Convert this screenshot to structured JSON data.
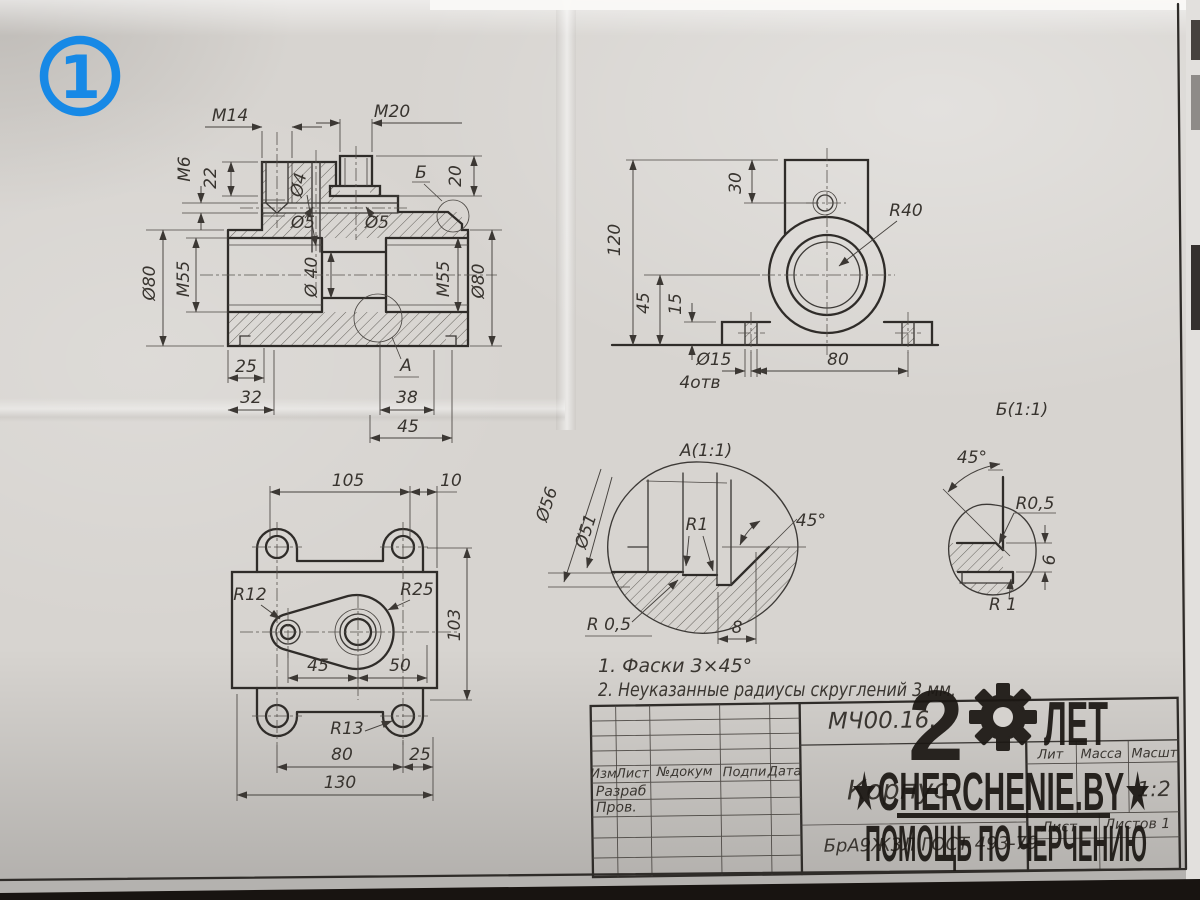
{
  "badge": {
    "number": "1",
    "color": "#1789e6"
  },
  "watermark": {
    "years": "2",
    "years_word": "ЛЕТ",
    "site": "★CHERCHENIE.BY★",
    "tagline": "ПОМОЩЬ ПО ЧЕРЧЕНИЮ",
    "color": "#1b1713"
  },
  "notes": {
    "line1": "1. Фаски 3×45°",
    "line2": "2. Неуказанные радиусы скруглений 3 мм."
  },
  "section_view": {
    "labels": {
      "m14": "М14",
      "m20": "М20",
      "m6": "М6",
      "v22": "22",
      "d4": "Ø4",
      "d5a": "Ø5",
      "d5b": "Ø5",
      "cb": "Б",
      "v20": "20",
      "d80l": "Ø80",
      "m55l": "М55",
      "d40": "Ø 40",
      "m55r": "М55",
      "d80r": "Ø80",
      "v25": "25",
      "v32": "32",
      "ca": "А",
      "v38": "38",
      "v45": "45"
    }
  },
  "front_view": {
    "labels": {
      "v120": "120",
      "v30": "30",
      "r40": "R40",
      "v45": "45",
      "v15": "15",
      "d15": "Ø15",
      "holes": "4отв",
      "v80": "80"
    }
  },
  "top_view": {
    "labels": {
      "v105": "105",
      "v10": "10",
      "r12": "R12",
      "r25": "R25",
      "v103": "103",
      "v45": "45",
      "v50": "50",
      "r13": "R13",
      "v80": "80",
      "v25": "25",
      "v130": "130"
    }
  },
  "detail_a": {
    "title": "А(1:1)",
    "labels": {
      "d56": "Ø56",
      "d51": "Ø51",
      "r1": "R1",
      "ang": "45°",
      "r05": "R 0,5",
      "w8": "8"
    }
  },
  "detail_b": {
    "title": "Б(1:1)",
    "labels": {
      "ang": "45°",
      "r05": "R0,5",
      "h6": "6",
      "r1": "R 1"
    }
  },
  "title_block": {
    "doc_number": "МЧ00.16.",
    "part_name": "Корпус",
    "material": "БрА9Ж3Л ГОСТ 493-79",
    "scale_value": "1:2",
    "headers": {
      "izm": "Изм",
      "list": "Лист",
      "doc": "№докум",
      "sign": "Подпи",
      "date": "Дата",
      "lit": "Лит",
      "mass": "Масса",
      "scale": "Масшт",
      "sheet": "Лист",
      "sheets": "Листов 1"
    },
    "rows": {
      "razrab": "Разраб",
      "prov": "Пров."
    }
  }
}
